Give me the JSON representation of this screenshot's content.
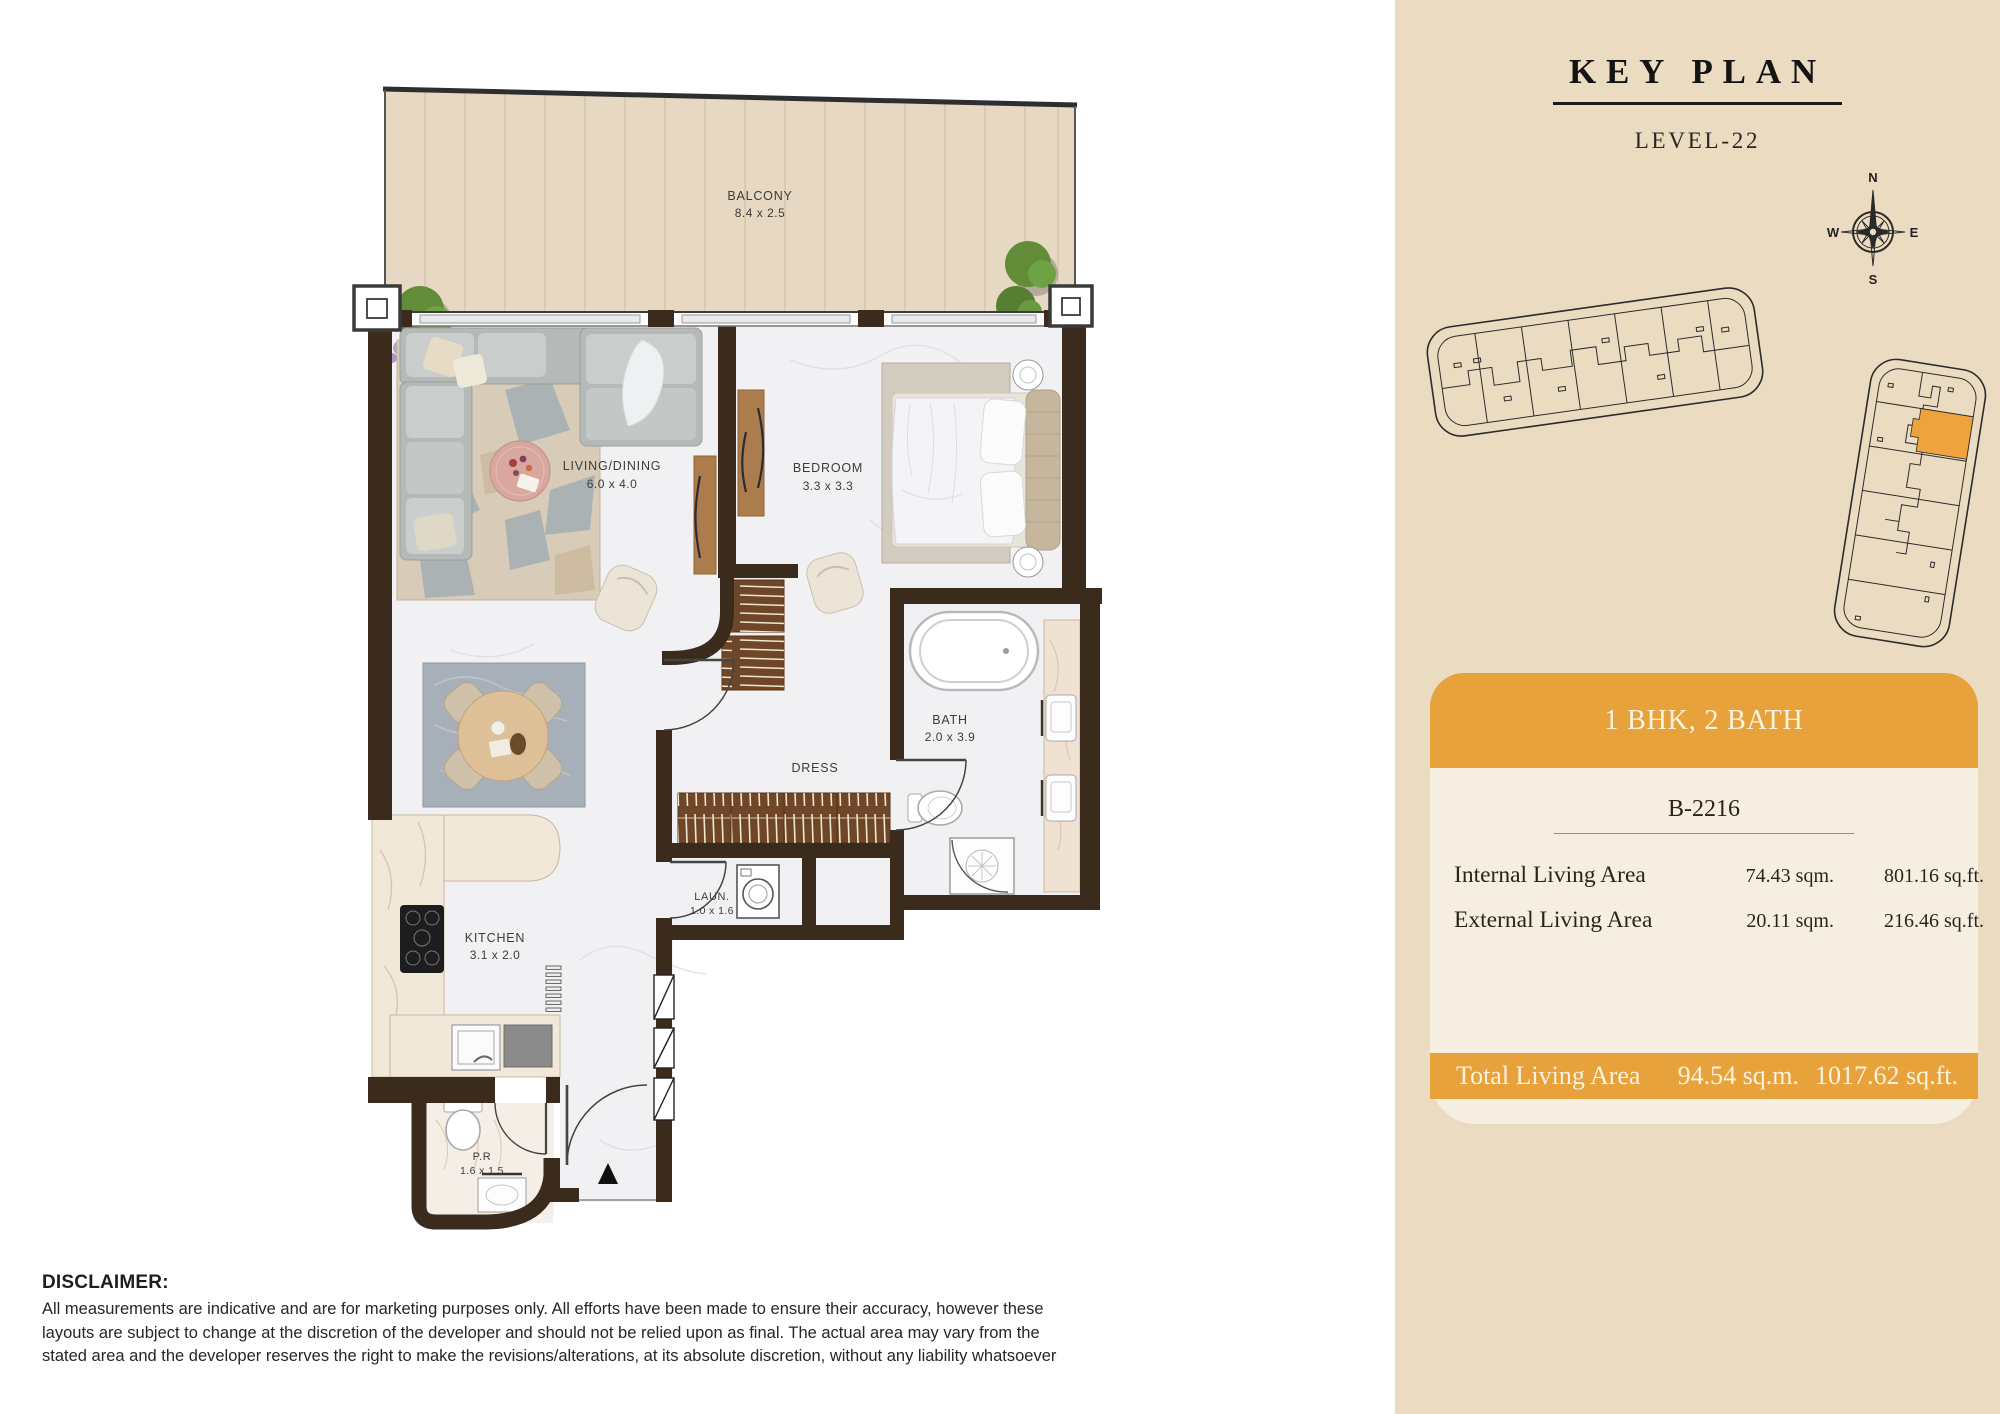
{
  "floor_plan": {
    "rooms": [
      {
        "name": "BALCONY",
        "dims": "8.4 x 2.5"
      },
      {
        "name": "LIVING/DINING",
        "dims": "6.0 x 4.0"
      },
      {
        "name": "BEDROOM",
        "dims": "3.3 x 3.3"
      },
      {
        "name": "BATH",
        "dims": "2.0 x 3.9"
      },
      {
        "name": "DRESS",
        "dims": ""
      },
      {
        "name": "LAUN.",
        "dims": "1.0 x 1.6"
      },
      {
        "name": "KITCHEN",
        "dims": "3.1 x 2.0"
      },
      {
        "name": "P.R",
        "dims": "1.6 x 1.5"
      }
    ]
  },
  "key_plan": {
    "title": "KEY PLAN",
    "level": "LEVEL-22",
    "compass": {
      "n": "N",
      "e": "E",
      "s": "S",
      "w": "W"
    }
  },
  "unit_card": {
    "type_label": "1 BHK, 2 BATH",
    "unit_number": "B-2216",
    "rows": [
      {
        "label": "Internal Living Area",
        "sqm": "74.43 sqm.",
        "sqft": "801.16 sq.ft."
      },
      {
        "label": "External Living Area",
        "sqm": "20.11 sqm.",
        "sqft": "216.46 sq.ft."
      }
    ],
    "total": {
      "label": "Total Living Area",
      "sqm": "94.54 sq.m.",
      "sqft": "1017.62 sq.ft."
    }
  },
  "disclaimer": {
    "heading": "DISCLAIMER:",
    "body": "All measurements are indicative and are for marketing purposes only. All efforts have been made to ensure their accuracy, however these layouts are subject to change at the discretion of the developer and should not be relied upon as final. The actual area may vary from the stated area and the developer reserves the right to make the revisions/alterations, at its absolute discretion, without any liability whatsoever"
  },
  "colors": {
    "accent_orange": "#E8A23C",
    "panel_beige": "#EBDCC1",
    "card_cream": "#F6EFE1",
    "wall_brown": "#3B2B1D"
  }
}
